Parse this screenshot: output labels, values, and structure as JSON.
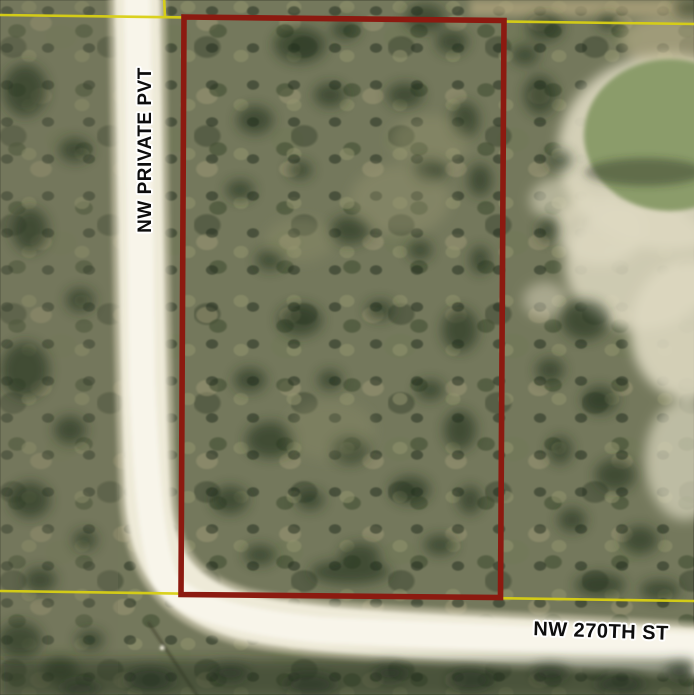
{
  "map": {
    "type": "aerial-parcel-map",
    "streets": {
      "private_road": {
        "label": "NW PRIVATE PVT",
        "orientation": "vertical"
      },
      "street_270th": {
        "label": "NW 270TH ST",
        "orientation": "horizontal"
      }
    },
    "parcel": {
      "outline_color": "#8c1a10",
      "shape": "rectangle"
    },
    "boundary_lines": {
      "color": "#d9d014"
    },
    "terrain_colors": {
      "road": "#eeead8",
      "road_center": "#f8f5ea",
      "pond_water": "#8b9c6a",
      "sand": "#ddd8c0",
      "vegetation": "#74785c",
      "dark_trees": "#22301f"
    },
    "label_style": {
      "text_color": "#0d0d0d",
      "halo_color": "#ffffff"
    }
  }
}
